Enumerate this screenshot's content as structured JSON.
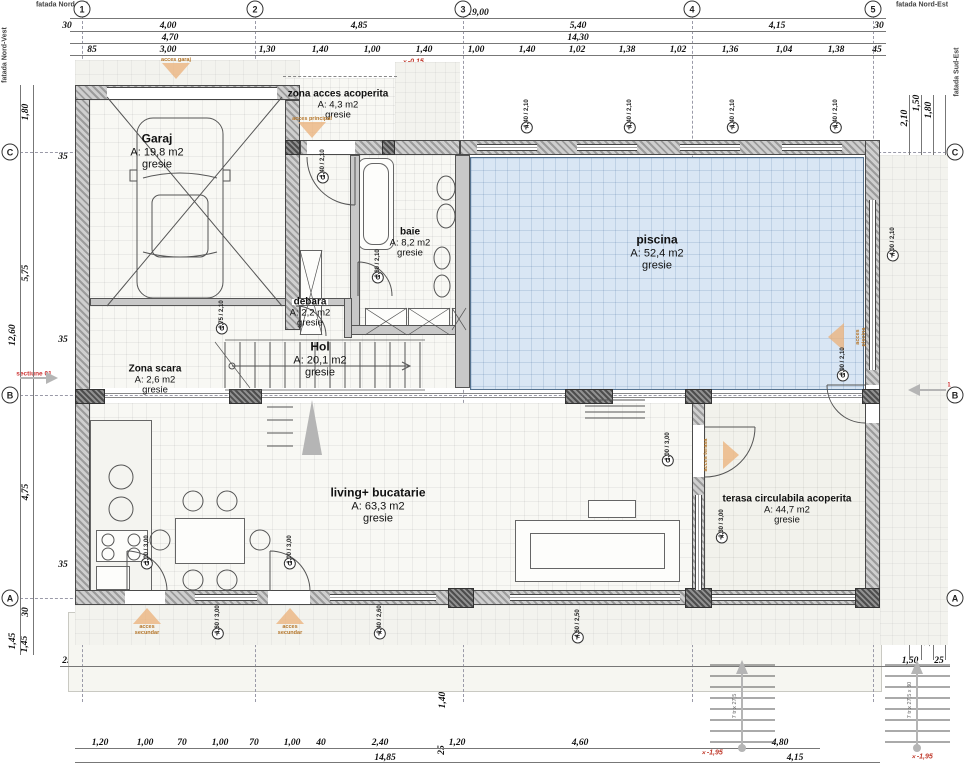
{
  "drawing": {
    "facade_top_left": "fatada Nord-Est",
    "facade_top_right": "fatada Nord-Est",
    "facade_right": "fatada Sud-Est",
    "facade_left": "fatada Nord-Vest",
    "section_left": "sectiune 01",
    "section_right": "sectiune 01",
    "stair_note": "17 tr x 27,5 x 17",
    "ext_stair_note": "7 tr x 27,5 x 30"
  },
  "axes": {
    "columns": [
      {
        "id": "1",
        "x": 82
      },
      {
        "id": "2",
        "x": 255
      },
      {
        "id": "3",
        "x": 463
      },
      {
        "id": "4",
        "x": 692
      },
      {
        "id": "5",
        "x": 873
      }
    ],
    "rows": [
      {
        "id": "C",
        "y": 152
      },
      {
        "id": "B",
        "y": 395
      },
      {
        "id": "A",
        "y": 598
      }
    ]
  },
  "rooms": [
    {
      "name": "Garaj",
      "area": "A: 19,8 m2",
      "finish": "gresie"
    },
    {
      "name": "zona acces acoperita",
      "area": "A: 4,3 m2",
      "finish": "gresie"
    },
    {
      "name": "baie",
      "area": "A: 8,2 m2",
      "finish": "gresie"
    },
    {
      "name": "piscina",
      "area": "A: 52,4 m2",
      "finish": "gresie"
    },
    {
      "name": "debara",
      "area": "A: 2,2 m2",
      "finish": "gresie"
    },
    {
      "name": "Zona scara",
      "area": "A: 2,6 m2",
      "finish": "gresie"
    },
    {
      "name": "Hol",
      "area": "A: 20,1 m2",
      "finish": "gresie"
    },
    {
      "name": "living+ bucatarie",
      "area": "A: 63,3 m2",
      "finish": "gresie"
    },
    {
      "name": "terasa circulabila acoperita",
      "area": "A: 44,7 m2",
      "finish": "gresie"
    }
  ],
  "dim_labels": [
    {
      "t": "19,00",
      "x": 478,
      "y": 13
    },
    {
      "t": "30",
      "x": 67,
      "y": 26
    },
    {
      "t": "4,00",
      "x": 168,
      "y": 26
    },
    {
      "t": "4,85",
      "x": 359,
      "y": 26
    },
    {
      "t": "5,40",
      "x": 578,
      "y": 26
    },
    {
      "t": "4,15",
      "x": 777,
      "y": 26
    },
    {
      "t": "30",
      "x": 879,
      "y": 26
    },
    {
      "t": "4,70",
      "x": 170,
      "y": 38
    },
    {
      "t": "14,30",
      "x": 578,
      "y": 38
    },
    {
      "t": "85",
      "x": 92,
      "y": 50
    },
    {
      "t": "3,00",
      "x": 168,
      "y": 50
    },
    {
      "t": "1,30",
      "x": 267,
      "y": 50
    },
    {
      "t": "1,40",
      "x": 320,
      "y": 50
    },
    {
      "t": "1,00",
      "x": 372,
      "y": 50
    },
    {
      "t": "1,40",
      "x": 424,
      "y": 50
    },
    {
      "t": "1,00",
      "x": 476,
      "y": 50
    },
    {
      "t": "1,40",
      "x": 527,
      "y": 50
    },
    {
      "t": "1,02",
      "x": 577,
      "y": 50
    },
    {
      "t": "1,38",
      "x": 627,
      "y": 50
    },
    {
      "t": "1,02",
      "x": 678,
      "y": 50
    },
    {
      "t": "1,36",
      "x": 730,
      "y": 50
    },
    {
      "t": "1,04",
      "x": 784,
      "y": 50
    },
    {
      "t": "1,38",
      "x": 836,
      "y": 50
    },
    {
      "t": "45",
      "x": 877,
      "y": 50
    },
    {
      "t": "1,80",
      "x": 26,
      "y": 112,
      "v": 1
    },
    {
      "t": "5,75",
      "x": 26,
      "y": 273,
      "v": 1
    },
    {
      "t": "12,60",
      "x": 13,
      "y": 335,
      "v": 1
    },
    {
      "t": "4,75",
      "x": 26,
      "y": 492,
      "v": 1
    },
    {
      "t": "30",
      "x": 26,
      "y": 612,
      "v": 1
    },
    {
      "t": "1,45",
      "x": 13,
      "y": 641,
      "v": 1
    },
    {
      "t": "1,45",
      "x": 25,
      "y": 644,
      "v": 1
    },
    {
      "t": "35",
      "x": 63,
      "y": 157
    },
    {
      "t": "1,25",
      "x": 93,
      "y": 119,
      "v": 1
    },
    {
      "t": "5,00",
      "x": 97,
      "y": 203,
      "v": 1
    },
    {
      "t": "3,35",
      "x": 97,
      "y": 282,
      "v": 1
    },
    {
      "t": "35",
      "x": 63,
      "y": 340
    },
    {
      "t": "2,00",
      "x": 97,
      "y": 357,
      "v": 1
    },
    {
      "t": "25",
      "x": 99,
      "y": 412,
      "v": 1
    },
    {
      "t": "35",
      "x": 63,
      "y": 565
    },
    {
      "t": "2,10",
      "x": 905,
      "y": 118,
      "v": 1
    },
    {
      "t": "1,50",
      "x": 917,
      "y": 103,
      "v": 1
    },
    {
      "t": "1,80",
      "x": 929,
      "y": 110,
      "v": 1
    },
    {
      "t": "4,00",
      "x": 911,
      "y": 237,
      "v": 1
    },
    {
      "t": "6,90",
      "x": 917,
      "y": 290,
      "v": 1
    },
    {
      "t": "5,75",
      "x": 929,
      "y": 280,
      "v": 1
    },
    {
      "t": "30",
      "x": 903,
      "y": 330,
      "v": 1
    },
    {
      "t": "90",
      "x": 905,
      "y": 368,
      "v": 1
    },
    {
      "t": "13,05",
      "x": 941,
      "y": 375,
      "v": 1
    },
    {
      "t": "1,25",
      "x": 904,
      "y": 416,
      "v": 1
    },
    {
      "t": "3,30",
      "x": 906,
      "y": 510,
      "v": 1
    },
    {
      "t": "3,70",
      "x": 917,
      "y": 513,
      "v": 1
    },
    {
      "t": "4,75",
      "x": 929,
      "y": 500,
      "v": 1
    },
    {
      "t": "2,20",
      "x": 906,
      "y": 628,
      "v": 1
    },
    {
      "t": "1,95",
      "x": 917,
      "y": 633,
      "v": 1
    },
    {
      "t": "1,75",
      "x": 928,
      "y": 638,
      "v": 1
    },
    {
      "t": "4,00",
      "x": 168,
      "y": 183
    },
    {
      "t": "15",
      "x": 252,
      "y": 183
    },
    {
      "t": "2,10",
      "x": 306,
      "y": 183
    },
    {
      "t": "15",
      "x": 348,
      "y": 183
    },
    {
      "t": "2,35",
      "x": 405,
      "y": 183
    },
    {
      "t": "25",
      "x": 450,
      "y": 183
    },
    {
      "t": "9,30",
      "x": 665,
      "y": 186
    },
    {
      "t": "35",
      "x": 875,
      "y": 183
    },
    {
      "t": "4,25",
      "x": 498,
      "y": 243,
      "v": 1
    },
    {
      "t": "5,65",
      "x": 800,
      "y": 280,
      "v": 1
    },
    {
      "t": "2,50",
      "x": 352,
      "y": 207,
      "v": 1
    },
    {
      "t": "3,50",
      "x": 444,
      "y": 232,
      "v": 1
    },
    {
      "t": "3,10",
      "x": 170,
      "y": 258
    },
    {
      "t": "80",
      "x": 233,
      "y": 258
    },
    {
      "t": "10",
      "x": 250,
      "y": 258
    },
    {
      "t": "50",
      "x": 273,
      "y": 258
    },
    {
      "t": "1,75",
      "x": 325,
      "y": 258
    },
    {
      "t": "2,50",
      "x": 135,
      "y": 332
    },
    {
      "t": "15",
      "x": 188,
      "y": 332
    },
    {
      "t": "45",
      "x": 213,
      "y": 318
    },
    {
      "t": "80",
      "x": 237,
      "y": 318
    },
    {
      "t": "75",
      "x": 268,
      "y": 318
    },
    {
      "t": "3,60",
      "x": 273,
      "y": 332
    },
    {
      "t": "15",
      "x": 348,
      "y": 332
    },
    {
      "t": "2,25",
      "x": 283,
      "y": 357,
      "v": 1
    },
    {
      "t": "2,10",
      "x": 308,
      "y": 378
    },
    {
      "t": "1,40",
      "x": 350,
      "y": 362,
      "v": 1
    },
    {
      "t": "40",
      "x": 257,
      "y": 383
    },
    {
      "t": "1,10",
      "x": 287,
      "y": 432,
      "v": 1
    },
    {
      "t": "2,35",
      "x": 405,
      "y": 332
    },
    {
      "t": "90",
      "x": 452,
      "y": 334,
      "v": 1
    },
    {
      "t": "2,00",
      "x": 440,
      "y": 357,
      "v": 1
    },
    {
      "t": "30",
      "x": 490,
      "y": 341,
      "v": 1
    },
    {
      "t": "1,40",
      "x": 505,
      "y": 365,
      "v": 1
    },
    {
      "t": "2,35",
      "x": 400,
      "y": 382
    },
    {
      "t": "1,50",
      "x": 441,
      "y": 105,
      "v": 1
    },
    {
      "t": "1,50",
      "x": 278,
      "y": 102,
      "v": 1
    },
    {
      "t": "4,00",
      "x": 168,
      "y": 448
    },
    {
      "t": "15",
      "x": 252,
      "y": 448
    },
    {
      "t": "4,50",
      "x": 98,
      "y": 505,
      "v": 1
    },
    {
      "t": "4,50",
      "x": 444,
      "y": 507,
      "v": 1
    },
    {
      "t": "3,40",
      "x": 284,
      "y": 517,
      "v": 1
    },
    {
      "t": "3,80",
      "x": 787,
      "y": 448
    },
    {
      "t": "35",
      "x": 698,
      "y": 448
    },
    {
      "t": "35",
      "x": 875,
      "y": 448
    },
    {
      "t": "6,20",
      "x": 800,
      "y": 538,
      "v": 1
    },
    {
      "t": "25",
      "x": 67,
      "y": 661
    },
    {
      "t": "95",
      "x": 103,
      "y": 661
    },
    {
      "t": "13,50",
      "x": 407,
      "y": 661
    },
    {
      "t": "1,45",
      "x": 97,
      "y": 642,
      "v": 1
    },
    {
      "t": "1,45",
      "x": 443,
      "y": 641,
      "v": 1
    },
    {
      "t": "1,40",
      "x": 443,
      "y": 700,
      "v": 1
    },
    {
      "t": "25",
      "x": 442,
      "y": 750,
      "v": 1
    },
    {
      "t": "25",
      "x": 693,
      "y": 661
    },
    {
      "t": "1,50",
      "x": 740,
      "y": 661
    },
    {
      "t": "25",
      "x": 768,
      "y": 661
    },
    {
      "t": "1,95",
      "x": 825,
      "y": 661
    },
    {
      "t": "35",
      "x": 876,
      "y": 661
    },
    {
      "t": "1,50",
      "x": 910,
      "y": 661
    },
    {
      "t": "25",
      "x": 939,
      "y": 661
    },
    {
      "t": "1,20",
      "x": 100,
      "y": 743
    },
    {
      "t": "1,00",
      "x": 145,
      "y": 743
    },
    {
      "t": "70",
      "x": 182,
      "y": 743
    },
    {
      "t": "1,00",
      "x": 220,
      "y": 743
    },
    {
      "t": "70",
      "x": 254,
      "y": 743
    },
    {
      "t": "1,00",
      "x": 292,
      "y": 743
    },
    {
      "t": "40",
      "x": 321,
      "y": 743
    },
    {
      "t": "2,40",
      "x": 380,
      "y": 743
    },
    {
      "t": "1,20",
      "x": 457,
      "y": 743
    },
    {
      "t": "4,60",
      "x": 580,
      "y": 743
    },
    {
      "t": "4,80",
      "x": 780,
      "y": 743
    },
    {
      "t": "14,85",
      "x": 385,
      "y": 758
    },
    {
      "t": "4,15",
      "x": 795,
      "y": 758
    }
  ],
  "level_marks": [
    {
      "t": "±0,00",
      "x": 355,
      "y": 118
    },
    {
      "t": "±0,00",
      "x": 113,
      "y": 206
    },
    {
      "t": "±0,00",
      "x": 315,
      "y": 295
    },
    {
      "t": "±0,00",
      "x": 627,
      "y": 352
    },
    {
      "t": "-0,15",
      "x": 413,
      "y": 62
    },
    {
      "t": "-0,15",
      "x": 878,
      "y": 344
    },
    {
      "t": "-1,50",
      "x": 607,
      "y": 278
    },
    {
      "t": "-0,90",
      "x": 307,
      "y": 467
    },
    {
      "t": "-0,90",
      "x": 767,
      "y": 463
    },
    {
      "t": "-0,90",
      "x": 903,
      "y": 457
    },
    {
      "t": "-0,90",
      "x": 308,
      "y": 640
    },
    {
      "t": "-1,95",
      "x": 712,
      "y": 753
    },
    {
      "t": "-1,95",
      "x": 922,
      "y": 757
    }
  ],
  "hp_labels": [
    {
      "t": "h.p.= 0,00",
      "x": 420,
      "y": 133
    },
    {
      "t": "h.p.= 0,00",
      "x": 518,
      "y": 162
    },
    {
      "t": "h.p.= 0,00",
      "x": 630,
      "y": 162
    },
    {
      "t": "h.p.= 0,00",
      "x": 733,
      "y": 162
    },
    {
      "t": "h.p.= 0,00",
      "x": 835,
      "y": 162
    },
    {
      "t": "h.p.= 0,00",
      "x": 858,
      "y": 253,
      "v": 1
    },
    {
      "t": "h.p.= 0,00",
      "x": 684,
      "y": 480,
      "v": 1
    },
    {
      "t": "h.p.= 0,00",
      "x": 217,
      "y": 585
    },
    {
      "t": "h.p.= 0,50",
      "x": 378,
      "y": 585
    },
    {
      "t": "h.p.= 0,50",
      "x": 578,
      "y": 585
    }
  ],
  "opening_tags": [
    {
      "l": "F",
      "w": "1,40",
      "h": "2,10",
      "x": 527,
      "y": 122
    },
    {
      "l": "F",
      "w": "1,40",
      "h": "2,10",
      "x": 630,
      "y": 122
    },
    {
      "l": "F",
      "w": "1,40",
      "h": "2,10",
      "x": 733,
      "y": 122
    },
    {
      "l": "F",
      "w": "1,40",
      "h": "2,10",
      "x": 836,
      "y": 122
    },
    {
      "l": "F",
      "w": "4,00",
      "h": "2,10",
      "x": 893,
      "y": 250
    },
    {
      "l": "F",
      "w": "2,30",
      "h": "3,00",
      "x": 722,
      "y": 532
    },
    {
      "l": "F",
      "w": "1,60",
      "h": "3,00",
      "x": 218,
      "y": 628
    },
    {
      "l": "F",
      "w": "2,40",
      "h": "2,60",
      "x": 380,
      "y": 628
    },
    {
      "l": "F",
      "w": "4,60",
      "h": "2,50",
      "x": 578,
      "y": 632
    },
    {
      "l": "U",
      "w": "1,40",
      "h": "2,10",
      "x": 323,
      "y": 172
    },
    {
      "l": "U",
      "w": "0,80",
      "h": "2,10",
      "x": 378,
      "y": 272
    },
    {
      "l": "U",
      "w": "0,75",
      "h": "2,10",
      "x": 222,
      "y": 323
    },
    {
      "l": "U",
      "w": "0,90",
      "h": "2,10",
      "x": 843,
      "y": 370
    },
    {
      "l": "U",
      "w": "1,00",
      "h": "3,00",
      "x": 668,
      "y": 455
    },
    {
      "l": "U",
      "w": "1,00",
      "h": "3,00",
      "x": 147,
      "y": 558
    },
    {
      "l": "U",
      "w": "1,00",
      "h": "3,00",
      "x": 290,
      "y": 558
    }
  ],
  "tech_labels": [
    {
      "t": "MDR",
      "x": 388,
      "y": 324
    },
    {
      "t": "MSR",
      "x": 432,
      "y": 324
    },
    {
      "t": "MSV",
      "x": 101,
      "y": 452,
      "v": 1
    },
    {
      "t": "CT",
      "x": 107,
      "y": 577
    },
    {
      "t": "F",
      "x": 218,
      "y": 419
    },
    {
      "t": "F",
      "x": 247,
      "y": 419
    }
  ],
  "access_points": [
    {
      "label": "acces garaj",
      "x": 176,
      "y": 68,
      "dir": "down"
    },
    {
      "label": "acces principal",
      "x": 312,
      "y": 127,
      "dir": "down"
    },
    {
      "label": "acces secundar",
      "x": 147,
      "y": 622,
      "dir": "up"
    },
    {
      "label": "acces secundar",
      "x": 290,
      "y": 622,
      "dir": "up"
    },
    {
      "label": "acces piscina",
      "x": 853,
      "y": 337,
      "dir": "left"
    },
    {
      "label": "acces terasa",
      "x": 714,
      "y": 455,
      "dir": "right"
    }
  ]
}
